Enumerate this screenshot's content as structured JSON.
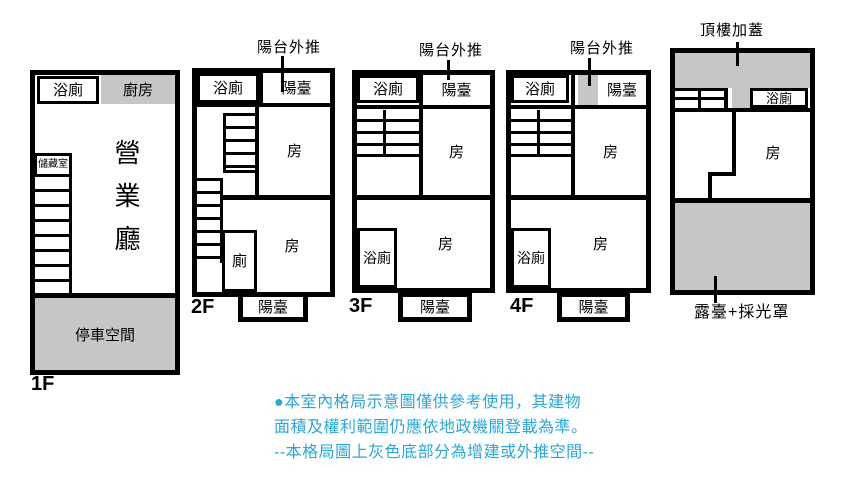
{
  "colors": {
    "wall": "#000000",
    "gray": "#c6c6c6",
    "note": "#29a7dc"
  },
  "floor1": {
    "label": "1F",
    "bathroom": "浴廁",
    "kitchen": "廚房",
    "storage": "儲藏室",
    "hall": "營業廳",
    "parking": "停車空間"
  },
  "floor2": {
    "label": "2F",
    "annotation": "陽台外推",
    "bathroom": "浴廁",
    "balcony_top": "陽臺",
    "room_upper": "房",
    "room_lower": "房",
    "toilet": "廁",
    "balcony_bottom": "陽臺"
  },
  "floor3": {
    "label": "3F",
    "annotation": "陽台外推",
    "bathroom_top": "浴廁",
    "balcony_top": "陽臺",
    "room_upper": "房",
    "bathroom_lower": "浴廁",
    "room_lower": "房",
    "balcony_bottom": "陽臺"
  },
  "floor4": {
    "label": "4F",
    "annotation": "陽台外推",
    "bathroom_top": "浴廁",
    "balcony_top": "陽臺",
    "room_upper": "房",
    "bathroom_lower": "浴廁",
    "room_lower": "房",
    "balcony_bottom": "陽臺"
  },
  "roof": {
    "annotation": "頂樓加蓋",
    "bathroom": "浴廁",
    "room": "房",
    "terrace": "露臺+採光罩"
  },
  "disclaimer": {
    "line1": "●本室內格局示意圖僅供參考使用，其建物",
    "line2": "面積及權利範圍仍應依地政機關登載為準。",
    "line3": "--本格局圖上灰色底部分為增建或外推空間--"
  }
}
